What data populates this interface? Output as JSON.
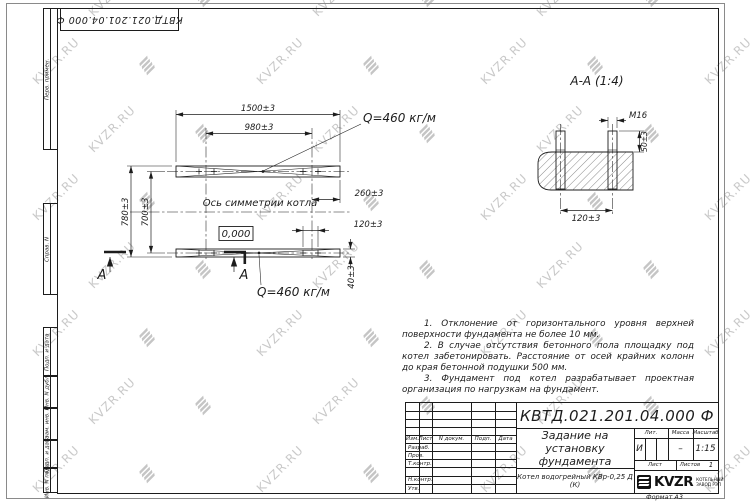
{
  "watermark": {
    "text": "KVZR.RU"
  },
  "stamps": {
    "top_doc_number": "КВТД.021.201.04.000 Ф"
  },
  "side_labels": [
    "Перв. примен.",
    "Справ. N",
    "Подп. и дата",
    "Инв. N дубл.",
    "Взам. инв. N",
    "Подп. и дата",
    "Инв. N подл."
  ],
  "drawing": {
    "axis_label": "Ось симметрии котла",
    "level_mark": "0,000",
    "load_label_top": "Q=460 кг/м",
    "load_label_bottom": "Q=460 кг/м",
    "section_letter_left": "А",
    "section_letter_right": "А",
    "dims": {
      "d1500": "1500±3",
      "d980": "980±3",
      "d260": "260±3",
      "d120": "120±3",
      "d40": "40±3",
      "d780": "780±3",
      "d700": "700±3"
    }
  },
  "section": {
    "title": "А-А (1:4)",
    "thread": "M16",
    "d50": "50±3",
    "d120": "120±3"
  },
  "notes": [
    "1. Отклонение от горизонтального уровня верхней поверхности фундамента не более 10 мм.",
    "2. В случае отсутствия бетонного пола площадку под котел забетонировать. Расстояние от осей крайних колонн до края бетонной подушки 500 мм.",
    "3. Фундамент под котел разрабатывает проектная организация по нагрузкам на фундамент."
  ],
  "title_block": {
    "doc_number": "КВТД.021.201.04.000 Ф",
    "title": "Задание на установку фундамента",
    "product": "Котел водогрейный КВр-0,25 Д (К)",
    "col_izm": "Изм.",
    "col_list": "Лист",
    "col_ndoc": "N докум.",
    "col_podp": "Подп.",
    "col_data": "Дата",
    "row_razrab": "Разраб.",
    "row_prov": "Пров.",
    "row_tkontr": "Т.контр.",
    "row_nkontr": "Н.контр.",
    "row_utv": "Утв.",
    "lit_header": "Лит.",
    "massa_header": "Масса",
    "masshtab_header": "Масштаб",
    "lit_value": "И",
    "massa_value": "–",
    "masshtab_value": "1:15",
    "list_label": "Лист",
    "listov_label": "Листов",
    "listov_value": "1",
    "logo_text": "KVZR",
    "logo_caption_line1": "КОТЕЛЬНЫЙ",
    "logo_caption_line2": "ЗАВОД РЭП",
    "format_label": "Формат А3"
  }
}
